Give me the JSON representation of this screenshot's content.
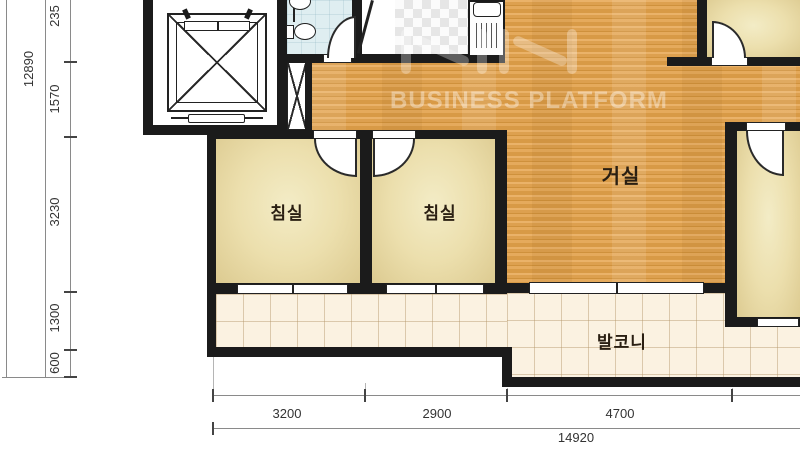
{
  "plan": {
    "rooms": {
      "bedroom1": "침실",
      "bedroom2": "침실",
      "living": "거실",
      "balcony": "발코니"
    },
    "icons": {
      "elevator": "elevator-shaft-icon",
      "duct": "duct-x-icon",
      "toilet": "toilet-icon",
      "basin": "wash-basin-icon",
      "kitchen_sink": "kitchen-sink-icon",
      "entrance_door": "entrance-door-leaf",
      "door_swing": "door-swing-icon",
      "window": "window"
    },
    "colors": {
      "wall": "#1b1b1b",
      "wood_floor": "#e0a355",
      "room_beige": "#ecdfad",
      "balcony_tile": "#fbf2e1",
      "bathroom_tile": "#dfeef1",
      "label_text": "#2a1f12",
      "dimension_text": "#333333"
    }
  },
  "dimensions": {
    "left": {
      "total": "12890",
      "segments": [
        "235",
        "1570",
        "3230",
        "1300",
        "600"
      ]
    },
    "bottom": {
      "total": "14920",
      "segments": [
        "3200",
        "2900",
        "4700"
      ]
    }
  },
  "watermark": {
    "text": "BUSINESS PLATFORM"
  }
}
